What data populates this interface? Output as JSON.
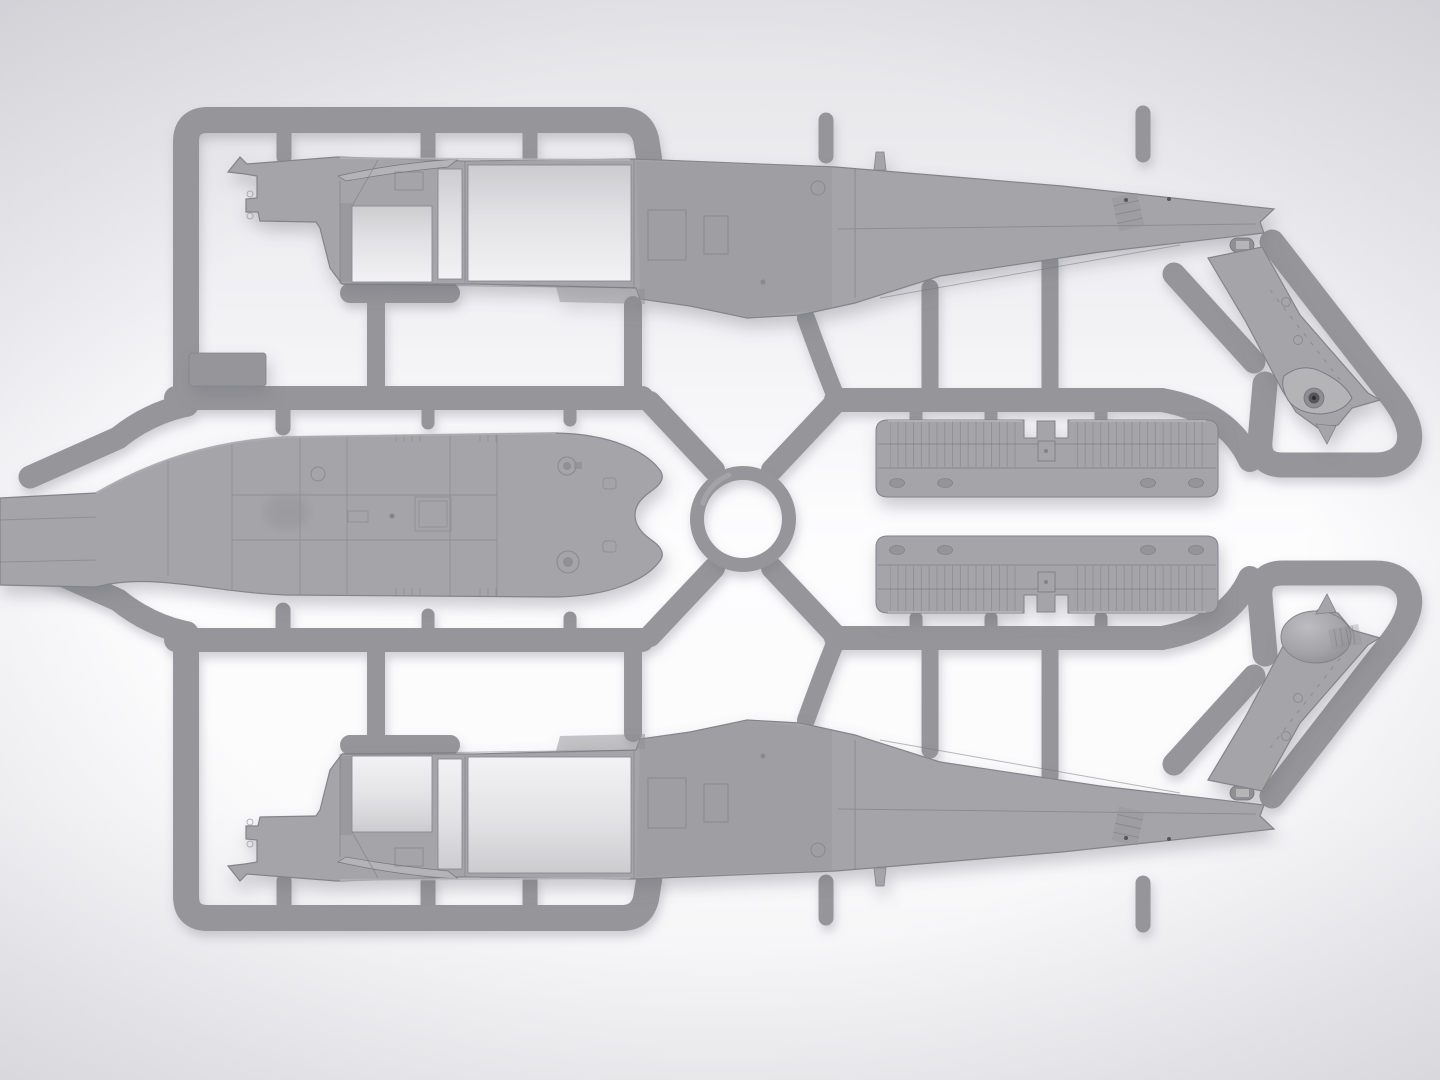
{
  "scene": {
    "description": "Render of a light-gray injection-molded plastic model kit sprue (runner frame) holding helicopter parts: two mirrored fuselage halves shown from the interior side, a cabin roof piece in plan view, two louvered engine-deck panels, and two tail-rotor pylon parts, laid on a bright white studio background.",
    "subject": "Model kit sprue with helicopter fuselage parts",
    "parts": [
      {
        "id": "fuselage-half-upper",
        "name": "Fuselage half, upper (interior view, nose left)"
      },
      {
        "id": "fuselage-half-lower",
        "name": "Fuselage half, lower mirrored (interior view, nose left)"
      },
      {
        "id": "cabin-roof",
        "name": "Cabin roof / upper deck piece, plan view"
      },
      {
        "id": "engine-deck-upper",
        "name": "Louvered engine deck panel (upper)"
      },
      {
        "id": "engine-deck-lower",
        "name": "Louvered engine deck panel (lower)"
      },
      {
        "id": "tail-pylon-upper",
        "name": "Tail rotor pylon with gearbox eye fairing"
      },
      {
        "id": "tail-pylon-lower",
        "name": "Tail rotor pylon with dome fairing"
      },
      {
        "id": "step-plate",
        "name": "Small rectangular plate on left frame"
      },
      {
        "id": "sprue-ring",
        "name": "Central circular sprue ring"
      }
    ]
  },
  "colors": {
    "background_top": "#e5e5e8",
    "background_upper": "#f1f1f4",
    "background_center": "#fdfdfe",
    "background_lower": "#fbfbfc",
    "background_bottom": "#f1f1f3",
    "vignette": "#8c8c9b",
    "runner": "#96969a",
    "runner_highlight": "#aaaaae",
    "part": "#a5a5a9",
    "part_light": "#b5b5b8",
    "part_dark": "#8f8f94",
    "opening_top": "#cccccf",
    "opening_mid": "#e2e2e5",
    "opening_bottom": "#f2f2f4",
    "panel_line": "#74747b",
    "outline": "#83838a",
    "dome_light": "#bdbdc0",
    "dome_mid": "#a2a2a6",
    "dome_dark": "#88888d",
    "eye_outer": "#8e8e92",
    "eye_mid": "#55555a",
    "eye_dot": "#2e2e33",
    "shadow": "#6f6f7e"
  }
}
